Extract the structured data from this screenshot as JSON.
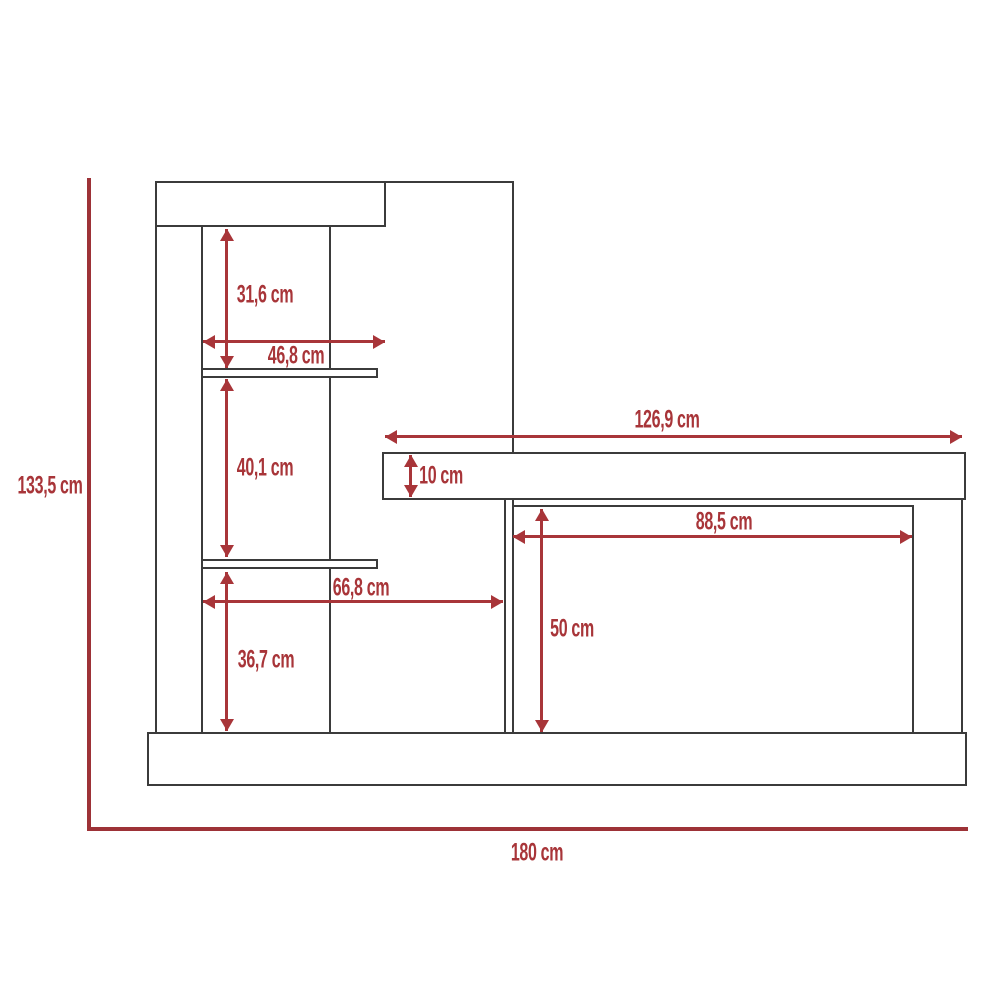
{
  "diagram": {
    "unit": "cm",
    "colors": {
      "dimension_red": "#a83539",
      "axis_red": "#9d3237",
      "outline_dark": "#3b3b3b",
      "background": "#ffffff"
    },
    "dims": {
      "total_height": "133,5 cm",
      "total_width": "180 cm",
      "upper_shelf_space_height": "31,6 cm",
      "shelf_width": "46,8 cm",
      "middle_shelf_space_height": "40,1 cm",
      "desktop_length": "126,9 cm",
      "desktop_thickness": "10 cm",
      "desk_opening_width": "88,5 cm",
      "lower_shelf_span_width": "66,8 cm",
      "desk_opening_height": "50 cm",
      "lower_shelf_space_height": "36,7 cm"
    }
  }
}
